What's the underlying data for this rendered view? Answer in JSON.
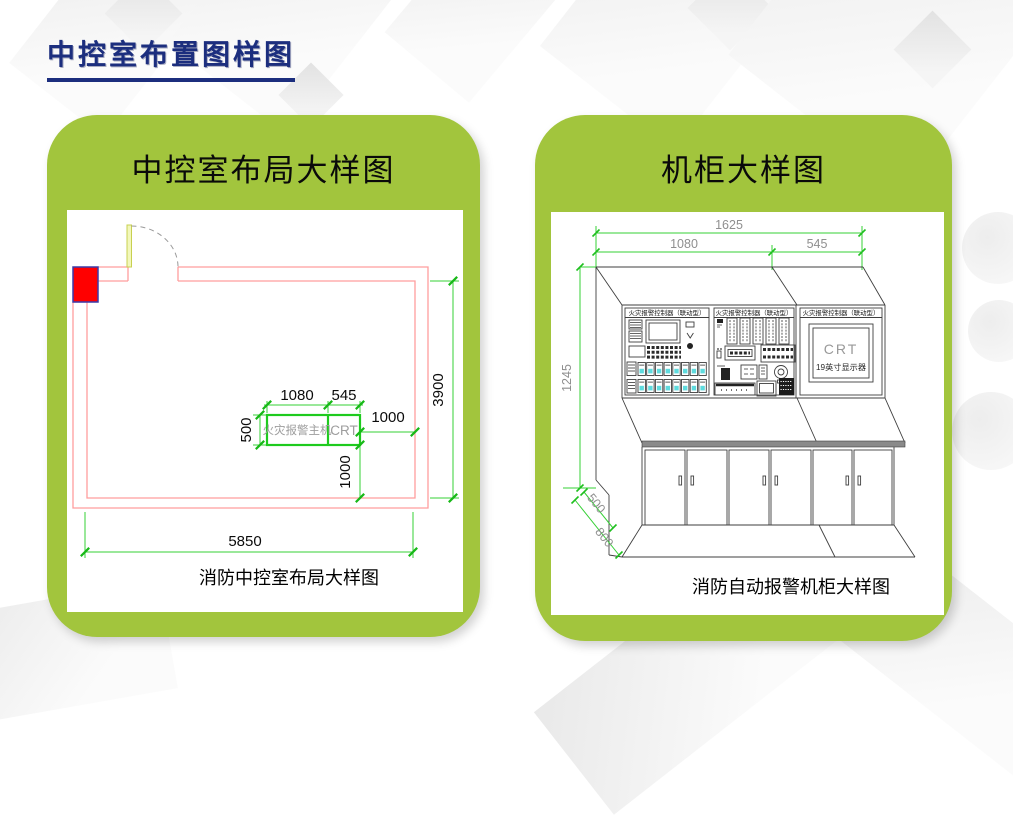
{
  "page": {
    "title": "中控室布置图样图"
  },
  "left_card": {
    "heading": "中控室布局大样图",
    "caption": "消防中控室布局大样图",
    "plan": {
      "equipment_label": "火灾报警主机",
      "crt_label": "CRT",
      "dims": {
        "w1080": "1080",
        "w545": "545",
        "h500": "500",
        "right1000": "1000",
        "bottom1000": "1000",
        "room_h": "3900",
        "room_w": "5850"
      }
    }
  },
  "right_card": {
    "heading": "机柜大样图",
    "caption": "消防自动报警机柜大样图",
    "cabinet": {
      "panel_headers": [
        "火灾报警控制器（联动型）",
        "火灾报警控制器（联动型）",
        "火灾报警控制器（联动型）"
      ],
      "crt_title": "CRT",
      "crt_subtitle": "19英寸显示器",
      "dims": {
        "total_w": "1625",
        "left_w": "1080",
        "right_w": "545",
        "height": "1245",
        "depth_front": "500",
        "depth_total": "800"
      }
    }
  },
  "colors": {
    "accent_green": "#a2c53d",
    "title_navy": "#1c2e7e",
    "dimension_green": "#35d035",
    "wall_pink": "#ff9d9d",
    "column_red": "#ff0000",
    "switch_cyan": "#5fdbde"
  }
}
